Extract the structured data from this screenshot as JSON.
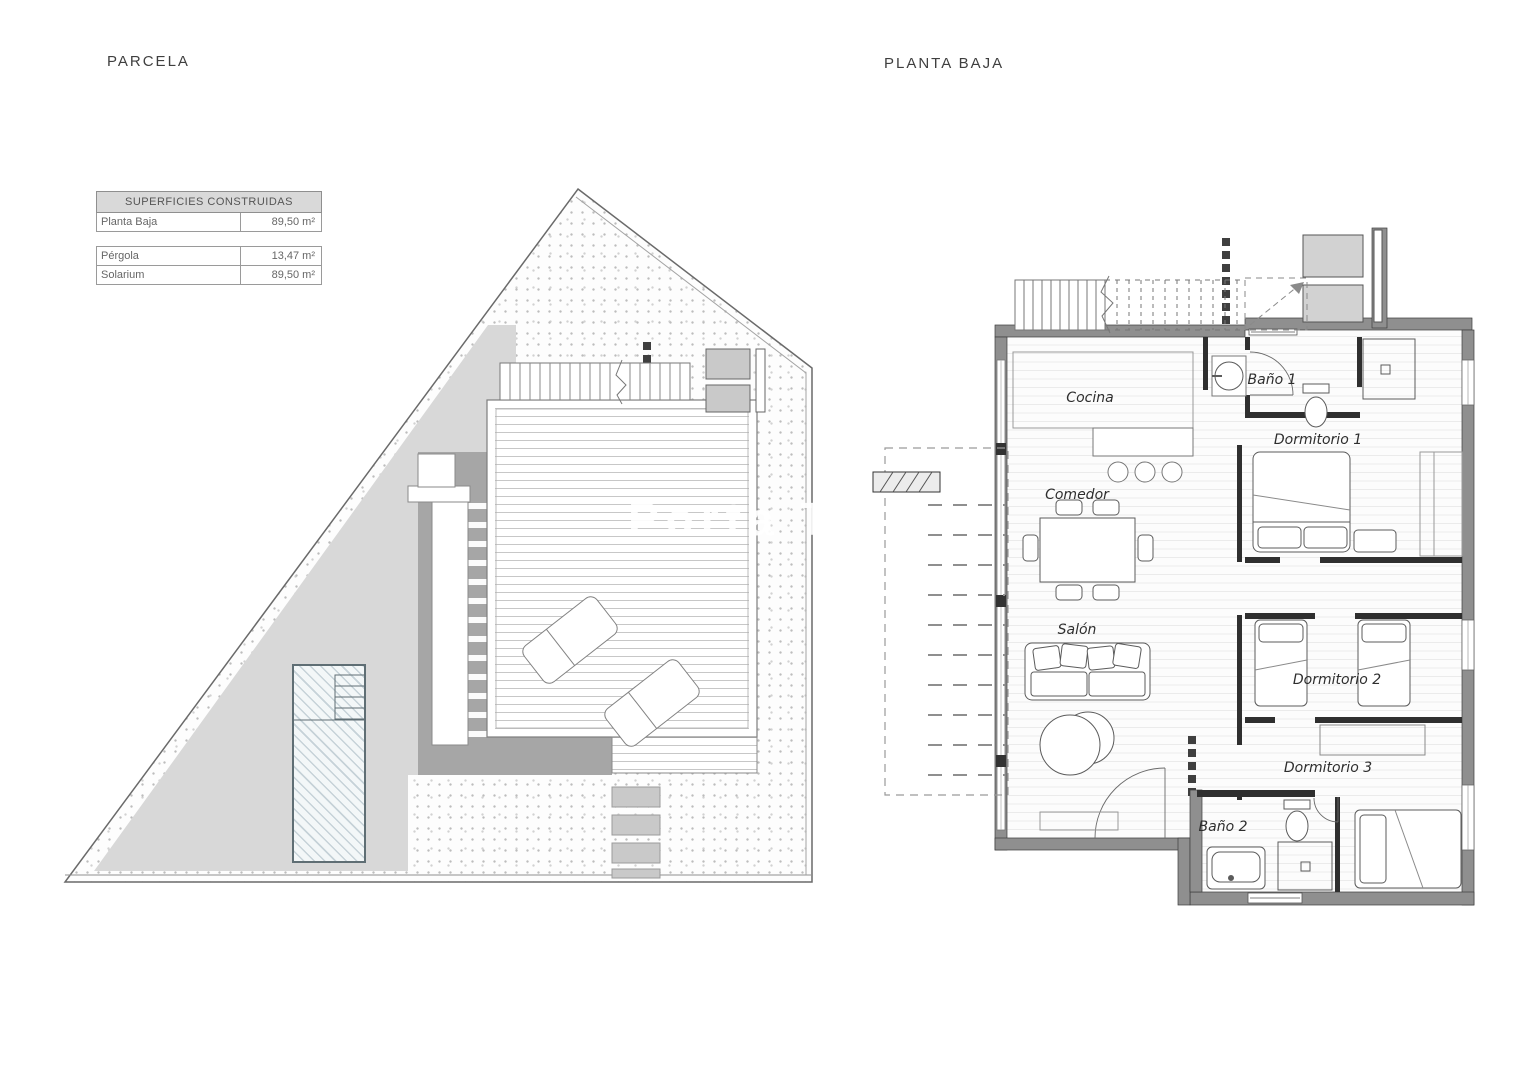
{
  "titles": {
    "site": "PARCELA",
    "floor": "PLANTA BAJA"
  },
  "areas_table": {
    "header": "SUPERFICIES CONSTRUIDAS",
    "rows": [
      {
        "label": "Planta Baja",
        "value": "89,50 m²"
      },
      {
        "label": "Pérgola",
        "value": "13,47 m²"
      },
      {
        "label": "Solarium",
        "value": "89,50 m²"
      }
    ]
  },
  "floor_plan": {
    "rooms": [
      {
        "label": "Cocina"
      },
      {
        "label": "Comedor"
      },
      {
        "label": "Salón"
      },
      {
        "label": "Baño 1"
      },
      {
        "label": "Dormitorio 1"
      },
      {
        "label": "Dormitorio 2"
      },
      {
        "label": "Dormitorio 3"
      },
      {
        "label": "Baño 2"
      }
    ]
  },
  "watermark": "Porta T",
  "colors": {
    "paving": "#d8d8d8",
    "shadow": "#a6a6a6",
    "exterior_wall": "#8f8f8f",
    "partition": "#2f2f2f",
    "table_header_bg": "#d9d9d9"
  }
}
